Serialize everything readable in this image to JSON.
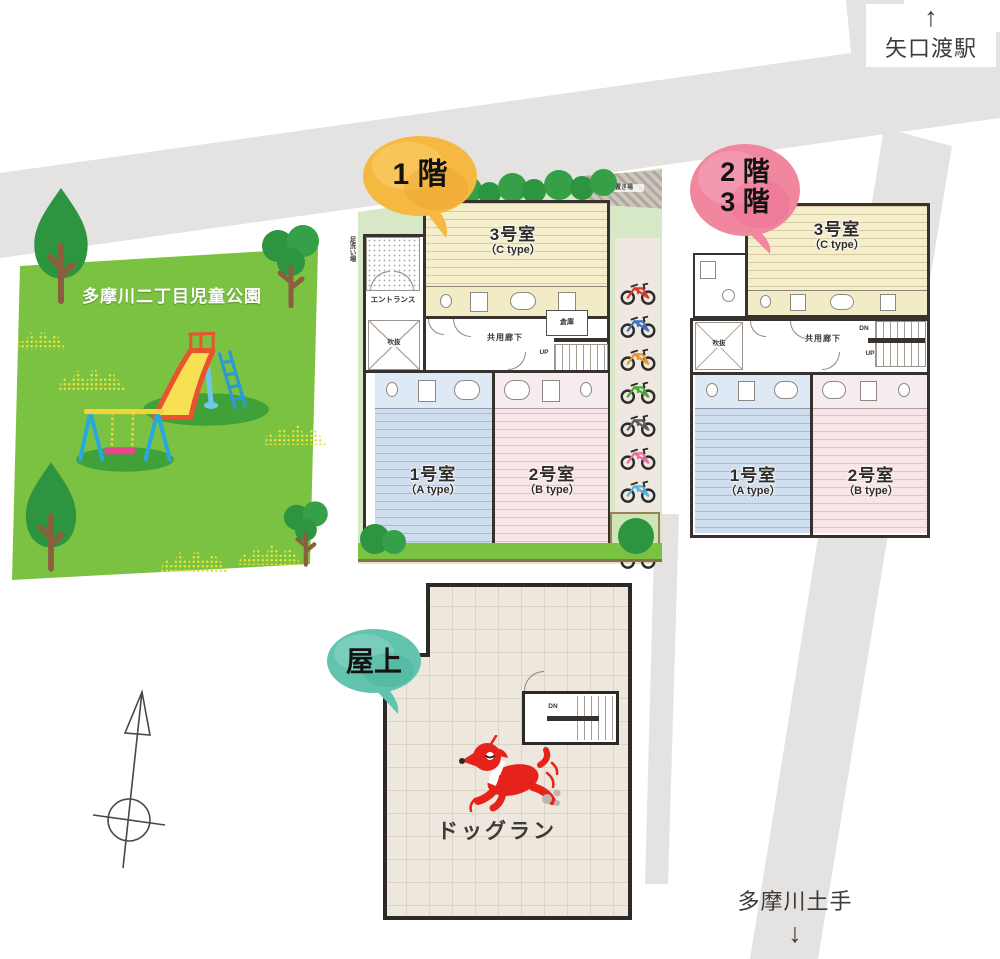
{
  "station": {
    "arrow": "↑",
    "name": "矢口渡駅"
  },
  "embankment": {
    "name": "多摩川土手",
    "arrow": "↓"
  },
  "park": {
    "name": "多摩川二丁目児童公園"
  },
  "balloons": {
    "floor1": "1 階",
    "floor23_top": "2 階",
    "floor23_bottom": "3 階",
    "roof": "屋上",
    "floor1_color": "#f5b942",
    "floor23_color": "#f0879f",
    "roof_color": "#62c3ae"
  },
  "floor1": {
    "garbage": "ゴミ置き場",
    "foot_wash": "足洗い場",
    "entrance": "エントランス",
    "void": "吹抜",
    "corridor": "共用廊下",
    "storage": "倉庫",
    "up": "UP",
    "room3_name": "3号室",
    "room3_type": "（C type）",
    "room1_name": "1号室",
    "room1_type": "（A type）",
    "room2_name": "2号室",
    "room2_type": "（B type）"
  },
  "floor23": {
    "void": "吹抜",
    "corridor": "共用廊下",
    "dn": "DN",
    "up": "UP",
    "room3_name": "3号室",
    "room3_type": "（C type）",
    "room1_name": "1号室",
    "room1_type": "（A type）",
    "room2_name": "2号室",
    "room2_type": "（B type）"
  },
  "roof": {
    "dn": "DN",
    "dog_run": "ドッグラン"
  },
  "bikes": [
    "#d93a2f",
    "#3f6fbf",
    "#e8962e",
    "#4ca83c",
    "#5a5a5a",
    "#e86fa0",
    "#53b4dc",
    "#7a6bb5",
    "#d8cc3a"
  ],
  "colors": {
    "road": "#e4e3e2",
    "park_green": "#7cc242",
    "room_c_cream": "#f4eecb",
    "room_a_blue": "#cfdeee",
    "room_b_pink": "#f9e4e8",
    "wall_dark": "#37322e",
    "dog_red": "#e5231b"
  }
}
